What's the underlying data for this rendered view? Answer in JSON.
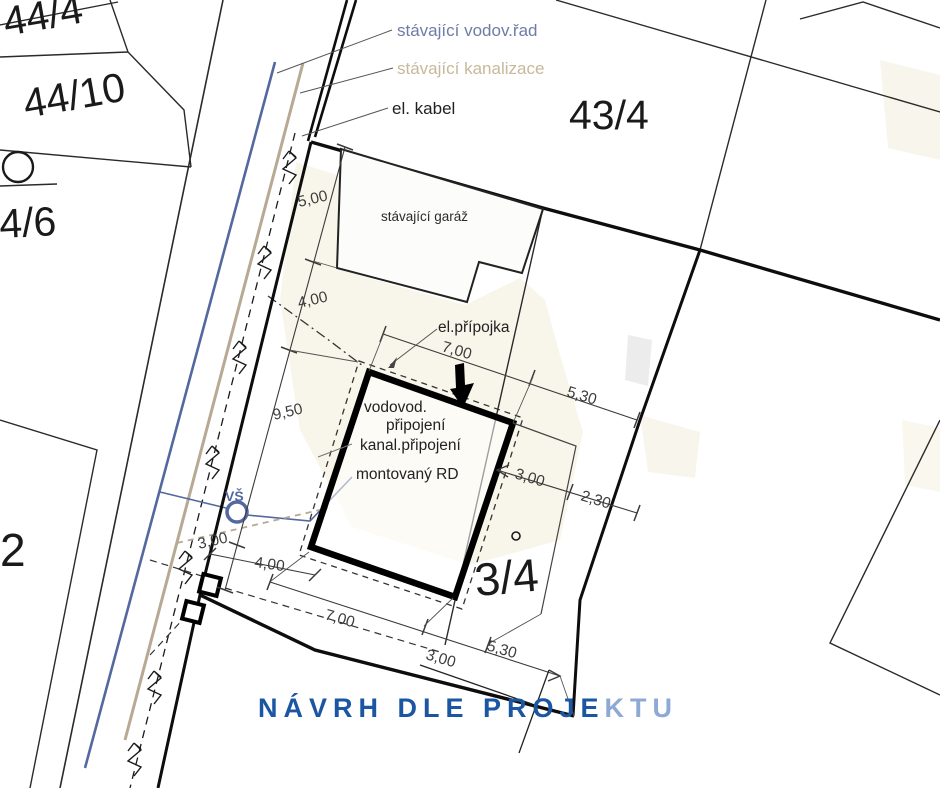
{
  "plan": {
    "parcels": {
      "p44_4": "44/4",
      "p44_10": "44/10",
      "p4_6": "4/6",
      "p2": "2",
      "p43_4": "43/4",
      "p3_4": "3/4"
    },
    "legend": {
      "water_main": "stávající vodov.řad",
      "sewer_main": "stávající kanalizace",
      "el_cable": "el. kabel"
    },
    "features": {
      "garage": "stávající garáž",
      "house": "montovaný RD",
      "el_service": "el.přípojka",
      "water_service_l1": "vodovod.",
      "water_service_l2": "připojení",
      "sewer_service": "kanal.připojení",
      "water_shaft": "VŠ"
    },
    "dims": {
      "top_width": "7,00",
      "top_east": "5,30",
      "east_1": "3,00",
      "east_2": "2,30",
      "west_1": "5,00",
      "west_2": "4,00",
      "west_3": "9,50",
      "gate": "3,00",
      "drive": "4,00",
      "south_1": "7,00",
      "south_2": "3,00",
      "south_3": "5,30"
    },
    "title": {
      "main": "NÁVRH DLE PROJE",
      "accent": "KTU"
    },
    "colors": {
      "water": "#5468a0",
      "sewer": "#b7a993",
      "water_label": "#6e7ca6",
      "sewer_label": "#c8b89b",
      "sewer_service_label": "#b0a295",
      "title_main": "#1b56a3",
      "title_accent": "#8fa9d6",
      "cream": "#f2edd9"
    }
  }
}
